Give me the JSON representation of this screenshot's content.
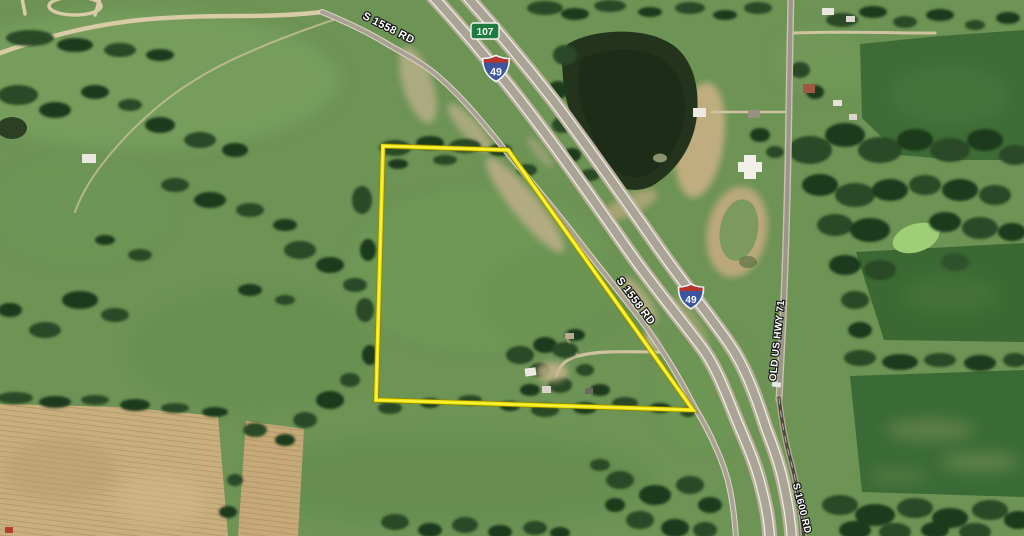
{
  "map": {
    "description": "Aerial satellite view of a rural property with a highlighted parcel boundary beside Interstate 49",
    "road_labels": {
      "s1558_top": "S 1558 RD",
      "s1558_mid": "S 1558 RD",
      "old_us_hwy_71": "OLD US HWY 71",
      "s1600_rd": "S 1600 RD"
    },
    "route_shields": {
      "route_107": "107",
      "interstate_49_top": "49",
      "interstate_49_mid": "49"
    },
    "parcel_boundary": {
      "color": "#f2e400",
      "vertices_px": [
        [
          383,
          146
        ],
        [
          508,
          150
        ],
        [
          693,
          410
        ],
        [
          376,
          400
        ]
      ]
    },
    "palette": {
      "pasture_green": "#6d9355",
      "crop_dark_green": "#3e6a35",
      "tree_green": "#2b4a26",
      "harvested_tan": "#c9ae7e",
      "pavement_gray": "#a9a496",
      "water_dark": "#24341c",
      "shield_blue": "#3b55a0",
      "shield_red": "#b5342c",
      "route_marker_green": "#1e7a3f"
    }
  }
}
